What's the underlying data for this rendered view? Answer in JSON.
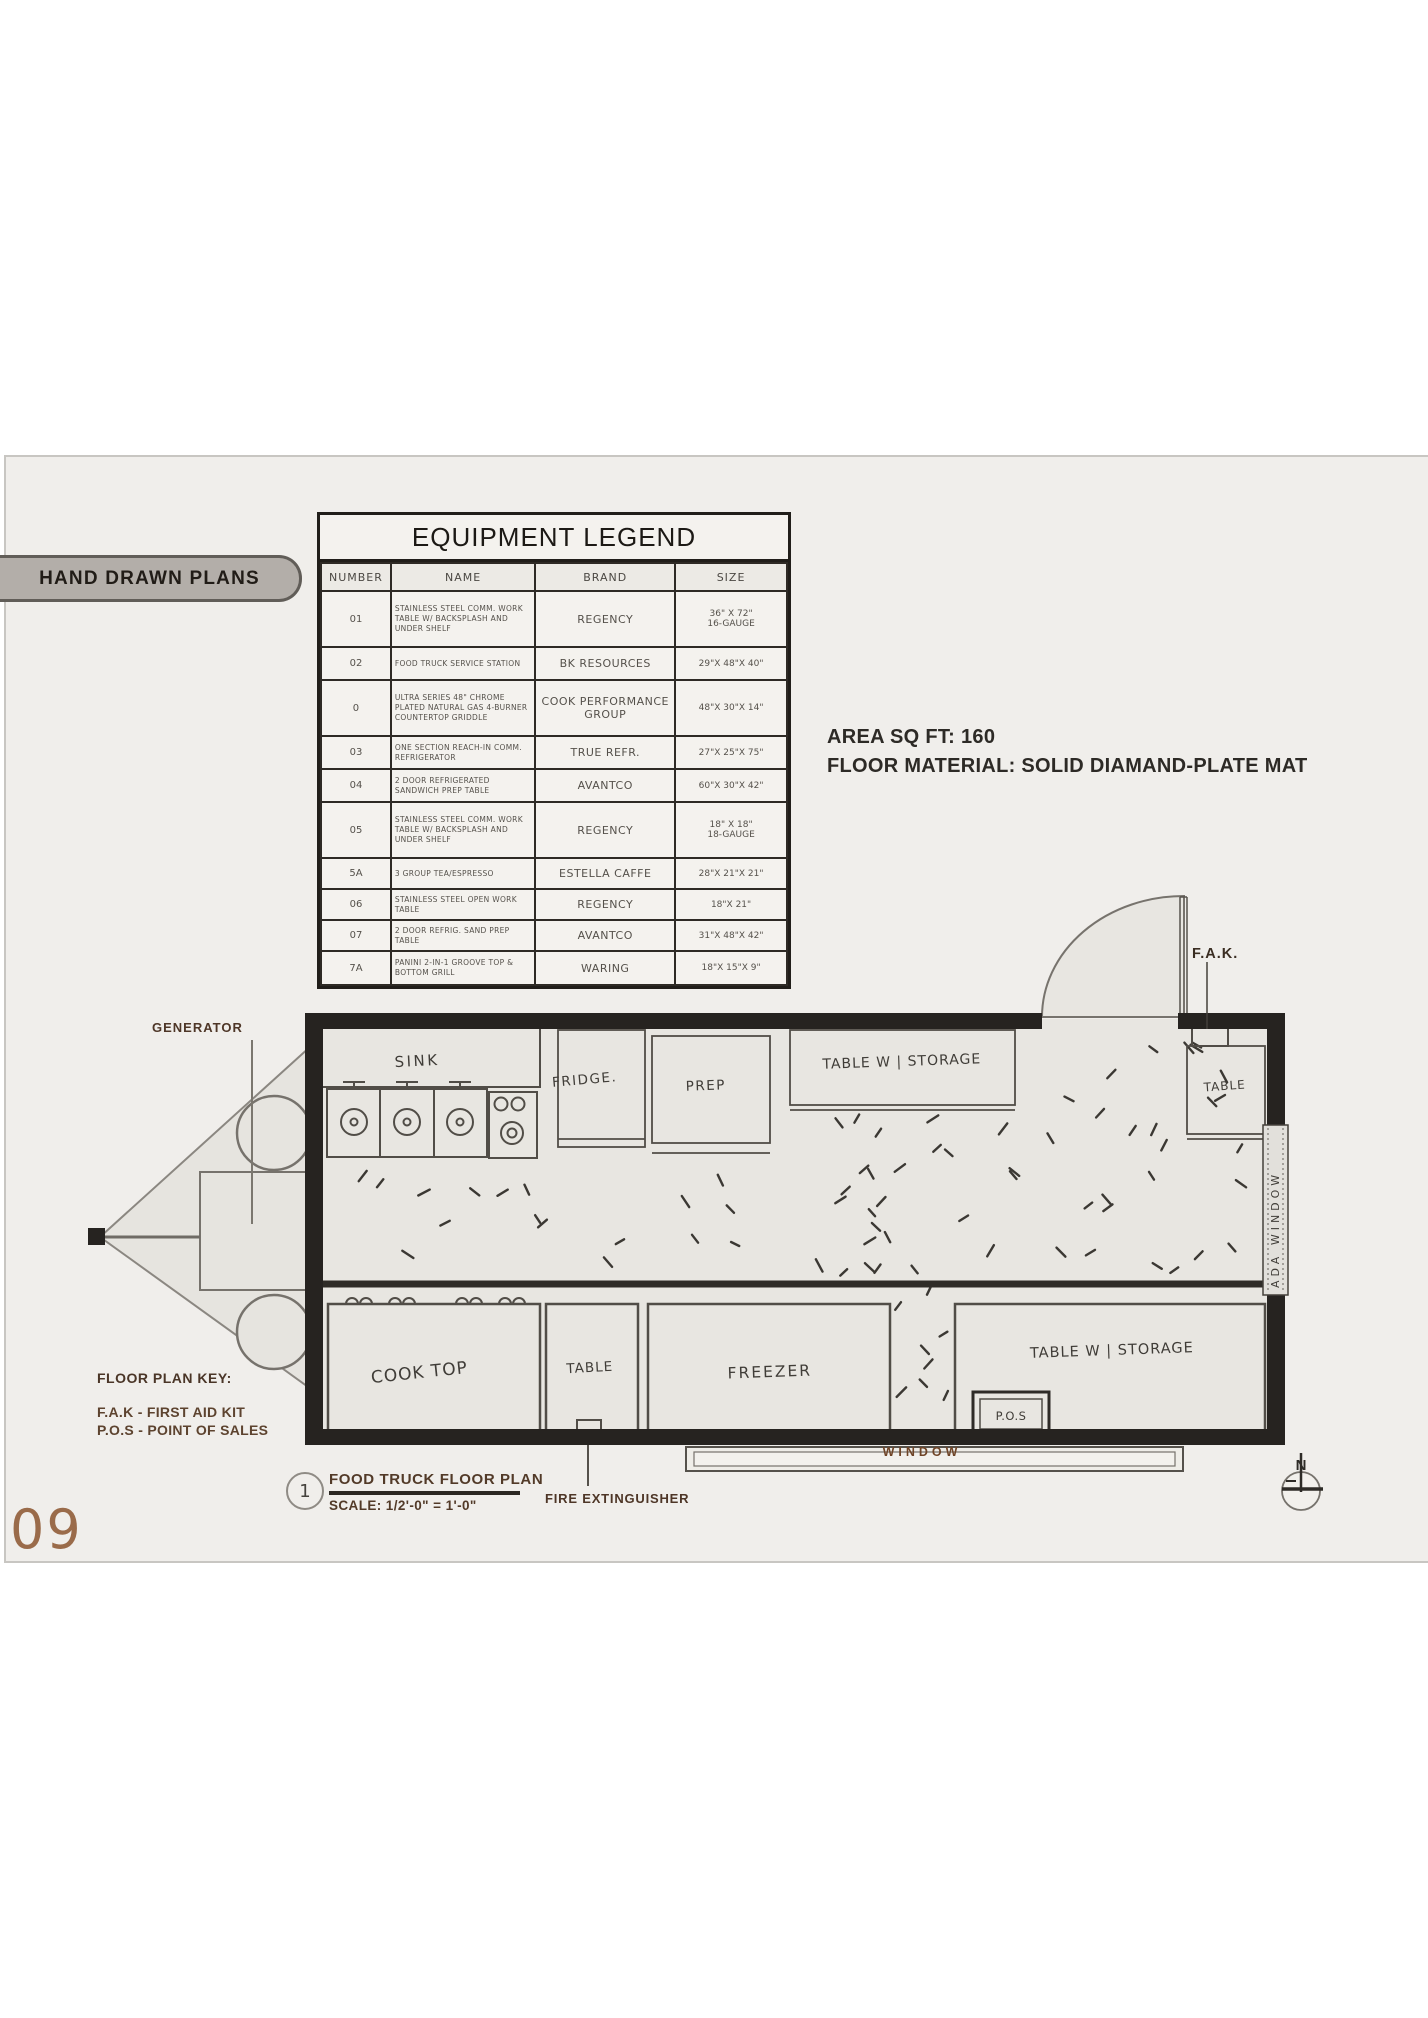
{
  "page": {
    "number": "09"
  },
  "tab": {
    "label": "HAND DRAWN PLANS"
  },
  "legend": {
    "title": "EQUIPMENT LEGEND",
    "columns": [
      "NUMBER",
      "NAME",
      "BRAND",
      "SIZE"
    ],
    "rows": [
      [
        "01",
        "STAINLESS STEEL COMM. WORK TABLE W/ BACKSPLASH AND UNDER SHELF",
        "REGENCY",
        "36\" X 72\"\n16-GAUGE"
      ],
      [
        "02",
        "FOOD TRUCK SERVICE STATION",
        "BK RESOURCES",
        "29\"X 48\"X 40\""
      ],
      [
        "0",
        "ULTRA SERIES 48\" CHROME PLATED NATURAL GAS 4-BURNER COUNTERTOP GRIDDLE",
        "COOK PERFORMANCE GROUP",
        "48\"X 30\"X 14\""
      ],
      [
        "03",
        "ONE SECTION REACH-IN COMM. REFRIGERATOR",
        "TRUE REFR.",
        "27\"X 25\"X 75\""
      ],
      [
        "04",
        "2 DOOR REFRIGERATED SANDWICH PREP TABLE",
        "AVANTCO",
        "60\"X 30\"X 42\""
      ],
      [
        "05",
        "STAINLESS STEEL COMM. WORK TABLE W/ BACKSPLASH AND UNDER SHELF",
        "REGENCY",
        "18\" X 18\"\n18-GAUGE"
      ],
      [
        "5A",
        "3 GROUP TEA/ESPRESSO",
        "ESTELLA CAFFE",
        "28\"X 21\"X 21\""
      ],
      [
        "06",
        "STAINLESS STEEL OPEN WORK TABLE",
        "REGENCY",
        "18\"X 21\""
      ],
      [
        "07",
        "2 DOOR REFRIG. SAND PREP TABLE",
        "AVANTCO",
        "31\"X 48\"X 42\""
      ],
      [
        "7A",
        "PANINI 2-IN-1 GROOVE TOP & BOTTOM GRILL",
        "WARING",
        "18\"X 15\"X 9\""
      ]
    ]
  },
  "specs": {
    "area": "AREA SQ FT: 160",
    "floor": "FLOOR MATERIAL: SOLID DIAMAND-PLATE MAT"
  },
  "plan": {
    "labels": {
      "generator": "GENERATOR",
      "sink": "SINK",
      "fridge": "FRIDGE.",
      "prep": "PREP",
      "table_storage_top": "TABLE W | STORAGE",
      "table_top_right": "TABLE",
      "fak": "F.A.K.",
      "ada_window": "ADA WINDOW",
      "cook_top": "COOK TOP",
      "table_bottom": "TABLE",
      "freezer": "FREEZER",
      "table_storage_bottom": "TABLE W | STORAGE",
      "pos": "P.O.S",
      "window": "WINDOW",
      "fire_extinguisher": "FIRE EXTINGUISHER",
      "north": "N"
    },
    "key": {
      "heading": "FLOOR PLAN KEY:",
      "items": [
        "F.A.K - FIRST AID KIT",
        "P.O.S - POINT OF SALES"
      ]
    },
    "titleblock": {
      "number": "1",
      "title": "FOOD TRUCK FLOOR PLAN",
      "scale": "SCALE: 1/2'-0\" = 1'-0\""
    }
  },
  "colors": {
    "panel_bg": "#f0eeeb",
    "paper": "#e8e6e1",
    "wall": "#262320",
    "accent_brown": "#523a28",
    "page_number_brown": "#9a6b4a"
  }
}
